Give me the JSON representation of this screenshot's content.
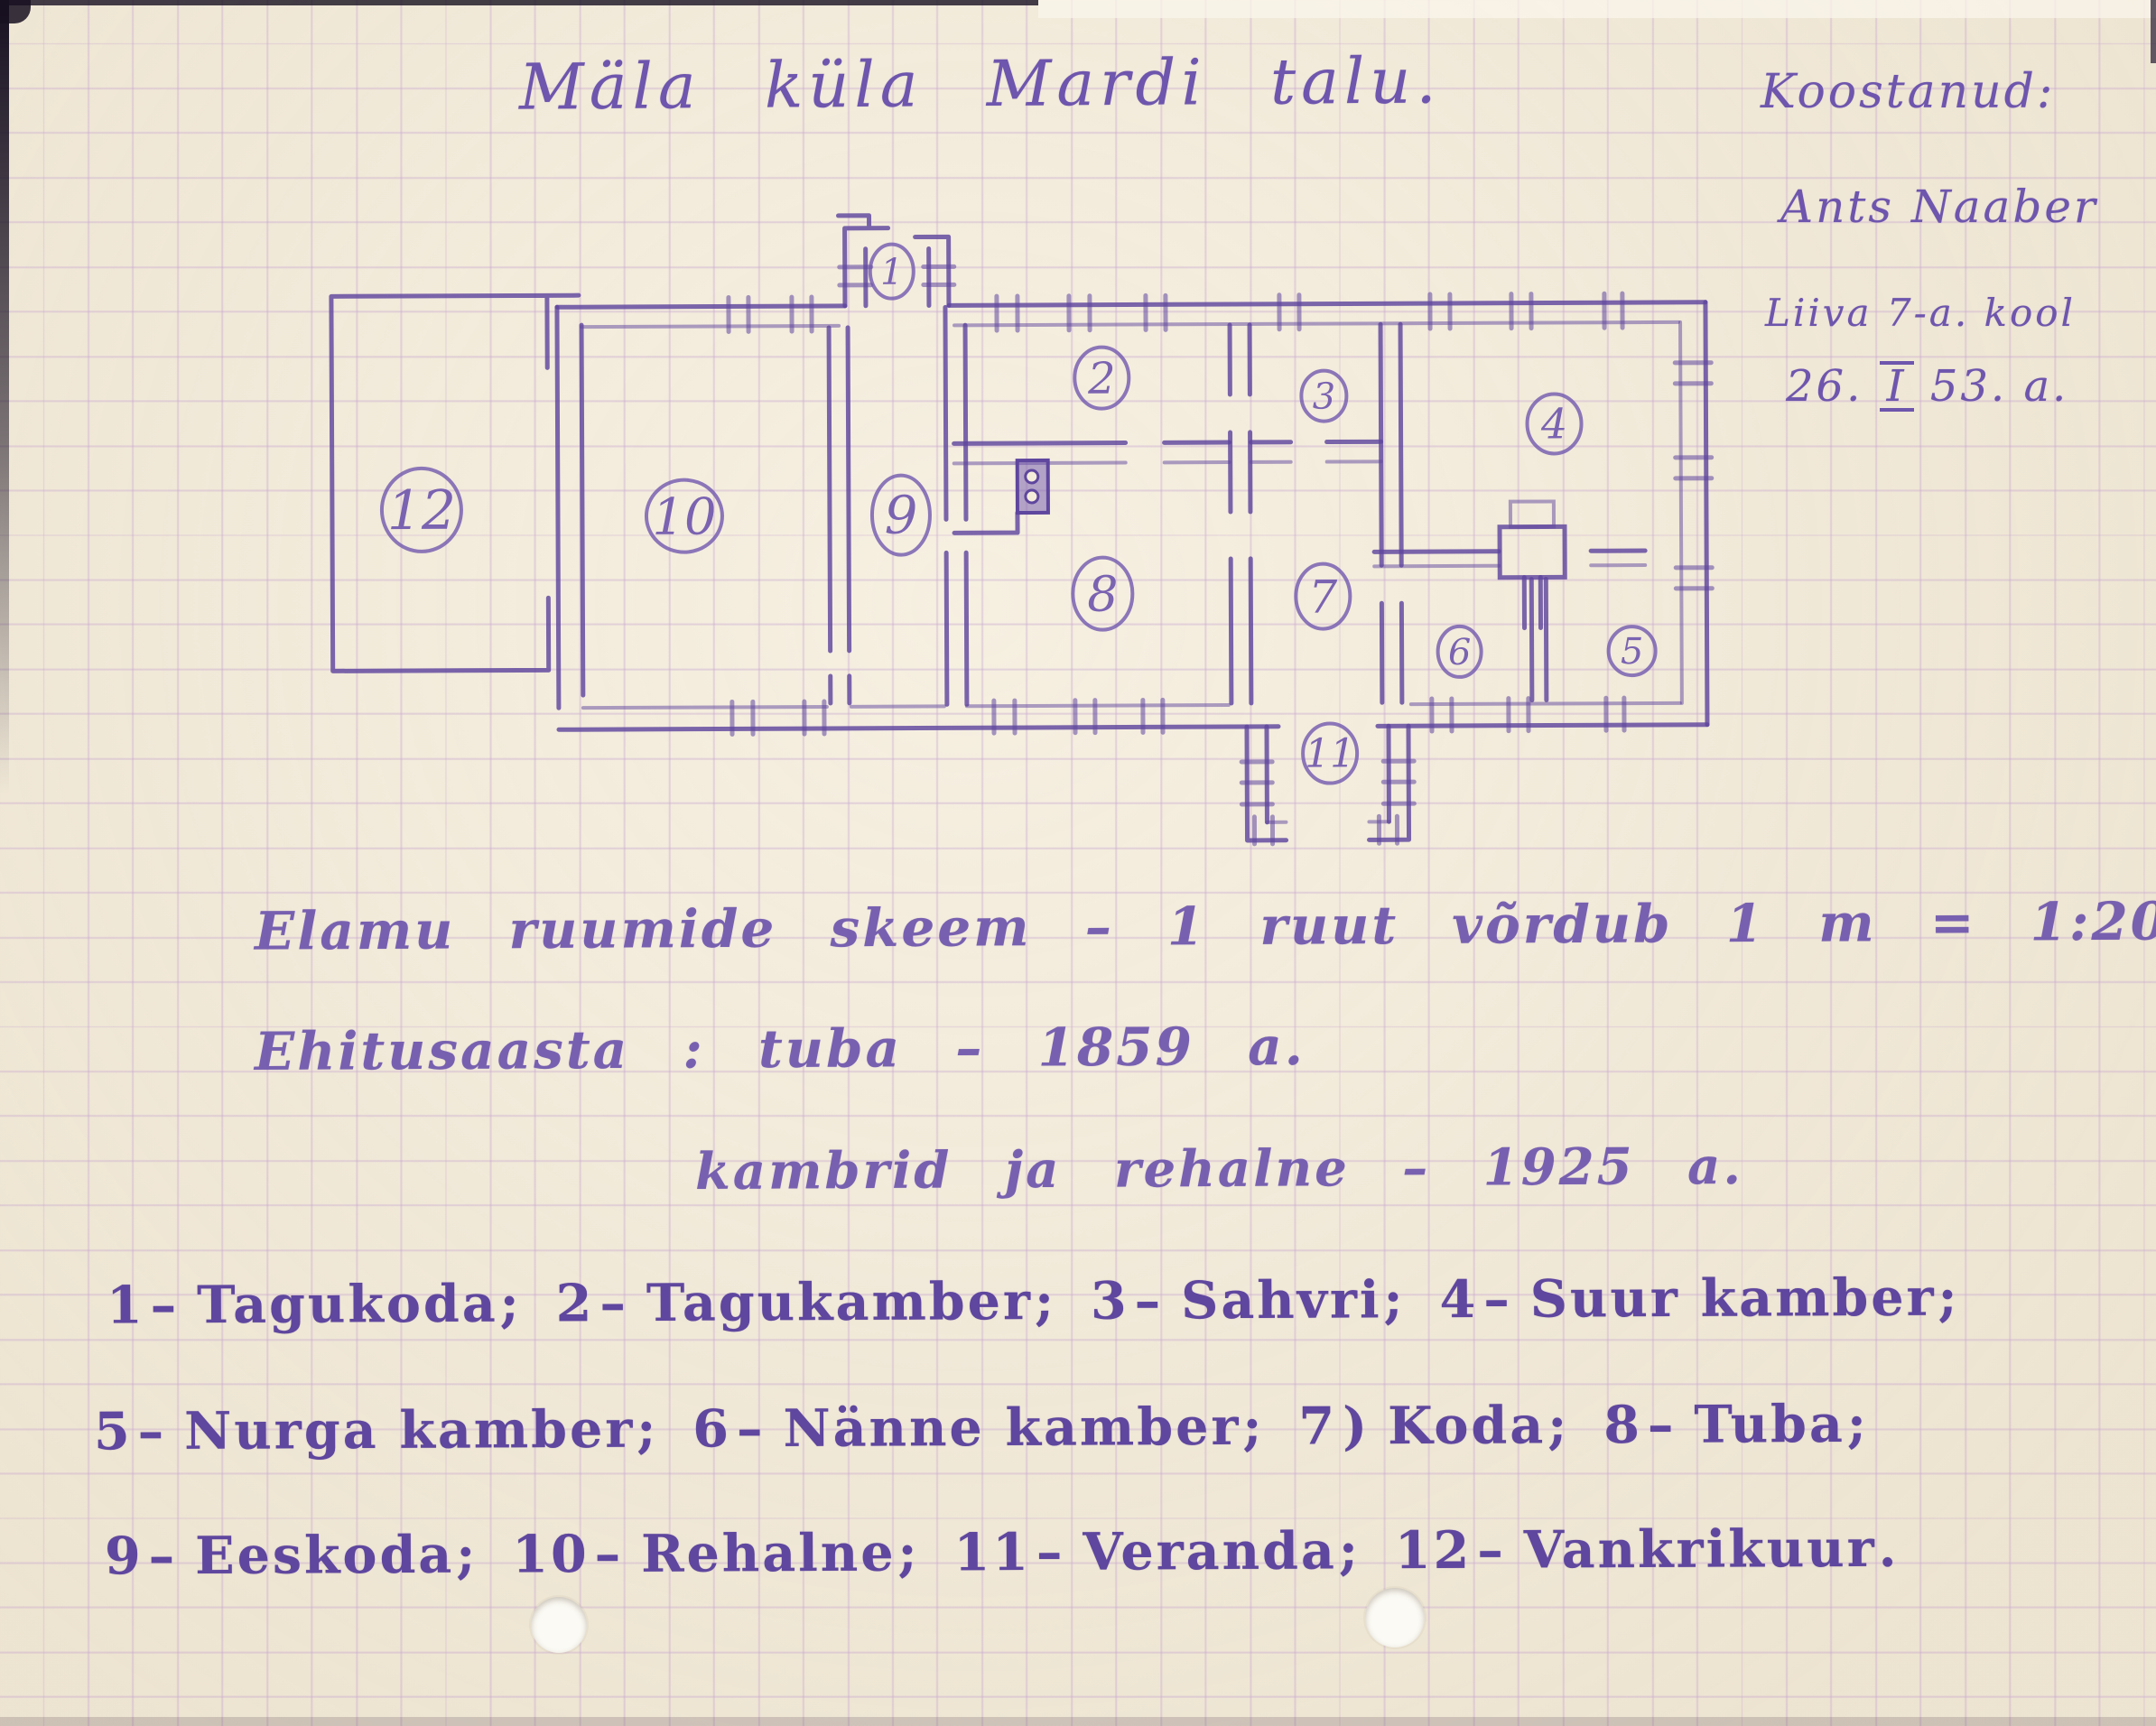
{
  "document": {
    "title": "Mäla küla Mardi talu.",
    "author_block": {
      "label": "Koostanud:",
      "name": "Ants Naaber",
      "school": "Liiva 7-a. kool",
      "date_prefix": "26.",
      "date_roman": "I",
      "date_suffix": "53. a."
    },
    "notes": {
      "scheme_line": "Elamu ruumide skeem – 1 ruut võrdub 1 m = 1:200",
      "built_line1": "Ehitusaasta : tuba – 1859 a.",
      "built_line2": "kambrid ja rehalne – 1925 a."
    },
    "legend": {
      "rows": [
        [
          {
            "num": "1",
            "sep": "–",
            "name": "Tagukoda",
            "end": ";"
          },
          {
            "num": "2",
            "sep": "–",
            "name": "Tagukamber",
            "end": ";"
          },
          {
            "num": "3",
            "sep": "–",
            "name": "Sahvri",
            "end": ";"
          },
          {
            "num": "4",
            "sep": "–",
            "name": "Suur kamber",
            "end": ";"
          }
        ],
        [
          {
            "num": "5",
            "sep": "–",
            "name": "Nurga kamber",
            "end": ";"
          },
          {
            "num": "6",
            "sep": "–",
            "name": "Nänne kamber",
            "end": ";"
          },
          {
            "num": "7",
            "sep": ")",
            "name": "Koda",
            "end": ";"
          },
          {
            "num": "8",
            "sep": "–",
            "name": "Tuba",
            "end": ";"
          }
        ],
        [
          {
            "num": "9",
            "sep": "–",
            "name": "Eeskoda",
            "end": ";"
          },
          {
            "num": "10",
            "sep": "–",
            "name": "Rehalne",
            "end": ";"
          },
          {
            "num": "11",
            "sep": "–",
            "name": "Veranda",
            "end": ";"
          },
          {
            "num": "12",
            "sep": "–",
            "name": "Vankrikuur",
            "end": "."
          }
        ]
      ]
    },
    "plan": {
      "rooms": [
        {
          "number": "1"
        },
        {
          "number": "2"
        },
        {
          "number": "3"
        },
        {
          "number": "4"
        },
        {
          "number": "5"
        },
        {
          "number": "6"
        },
        {
          "number": "7"
        },
        {
          "number": "8"
        },
        {
          "number": "9"
        },
        {
          "number": "10"
        },
        {
          "number": "11"
        },
        {
          "number": "12"
        }
      ]
    },
    "colors": {
      "ink": "#6e55ad",
      "ink_strong": "#5f469e",
      "paper": "#f4ecda",
      "grid_line": "#c7a7cf"
    }
  }
}
